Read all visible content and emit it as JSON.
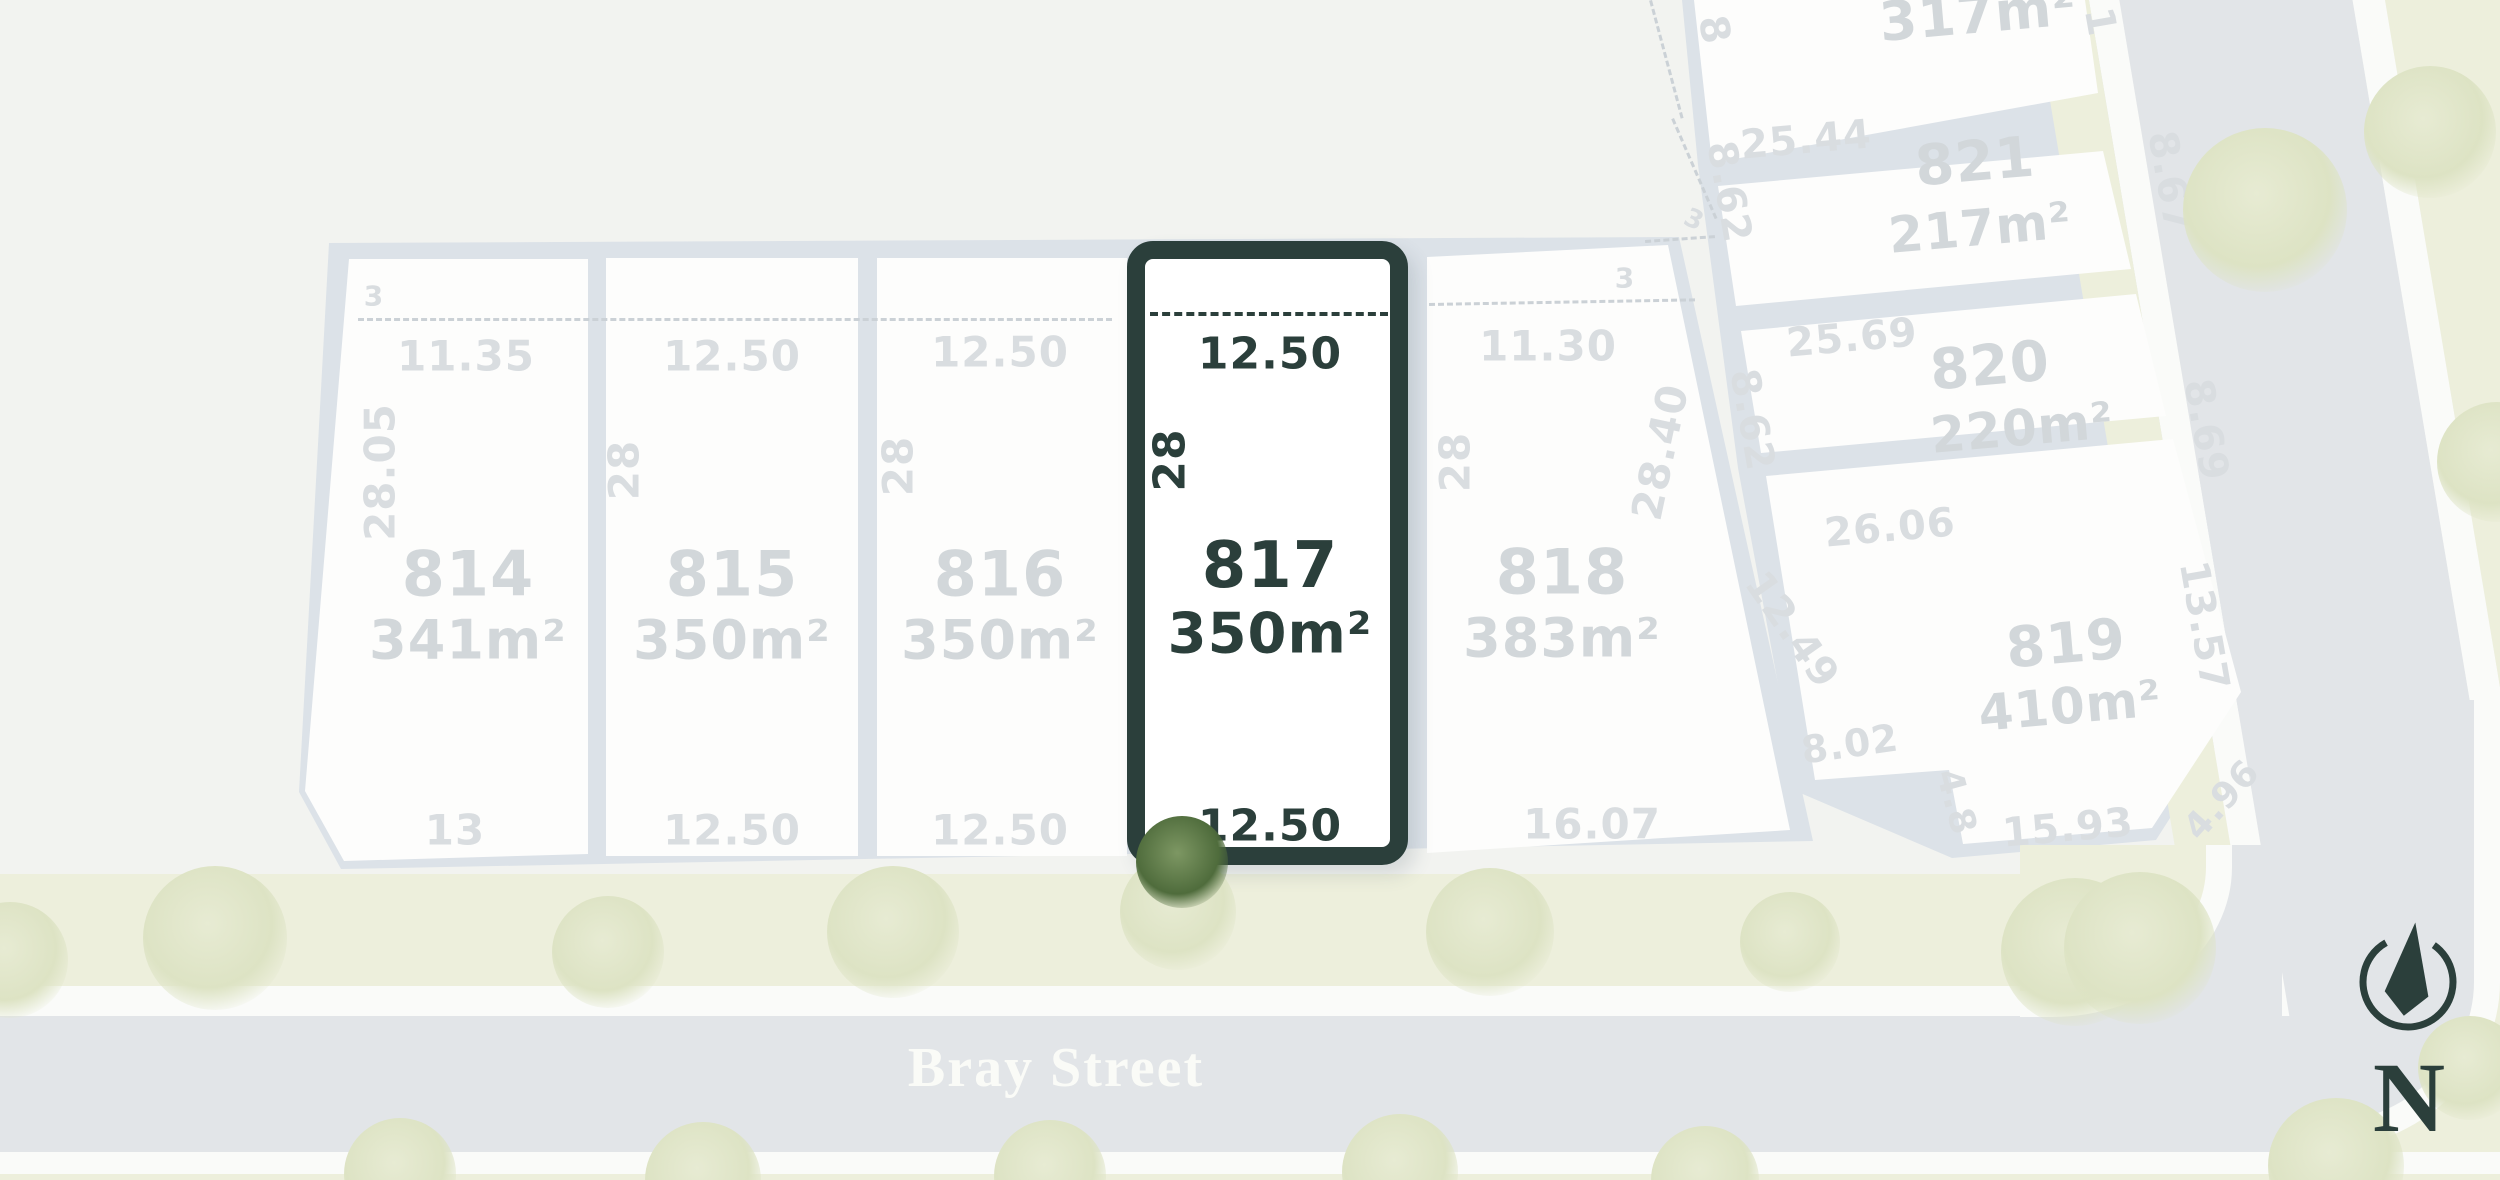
{
  "title": "Bray Street land release plan",
  "colors": {
    "accent": "#2b3f3b",
    "lot_fill": "#fdfdfc",
    "muted_text": "#d5dadd",
    "road": "#e2e5e8",
    "verge": "#edefdc"
  },
  "street": {
    "name": "Bray Street"
  },
  "compass": {
    "label": "N"
  },
  "partial_lot": {
    "area": "317m²",
    "dim_left": "8",
    "dim_right": "1"
  },
  "lots_left": [
    {
      "number": "814",
      "area": "341m²",
      "dim_top": "11.35",
      "dim_side": "28.05",
      "dim_front": "13",
      "setback": "3"
    },
    {
      "number": "815",
      "area": "350m²",
      "dim_top": "12.50",
      "dim_side": "28",
      "dim_front": "12.50"
    },
    {
      "number": "816",
      "area": "350m²",
      "dim_top": "12.50",
      "dim_side": "28",
      "dim_front": "12.50"
    },
    {
      "number": "817",
      "area": "350m²",
      "dim_top": "12.50",
      "dim_side": "28",
      "dim_front": "12.50",
      "highlighted": true
    },
    {
      "number": "818",
      "area": "383m²",
      "dim_top": "11.30",
      "dim_side": "28",
      "dim_side_right": "28.40",
      "dim_front": "16.07",
      "setback": "3"
    }
  ],
  "lots_right": [
    {
      "number": "821",
      "area": "217m²",
      "dim_top": "25.44",
      "dim_left": "8.62",
      "dim_right": "8.67",
      "setback": "3"
    },
    {
      "number": "820",
      "area": "220m²",
      "dim_top": "25.69",
      "dim_left": "8.62",
      "dim_right": "8.69"
    },
    {
      "number": "819",
      "area": "410m²",
      "dim_top": "26.06",
      "dim_left": "12.49",
      "dim_right": "13.57",
      "dim_notch_top": "8.02",
      "dim_notch_side": "4.8",
      "dim_bottom": "15.93",
      "dim_splay": "4.96"
    }
  ]
}
